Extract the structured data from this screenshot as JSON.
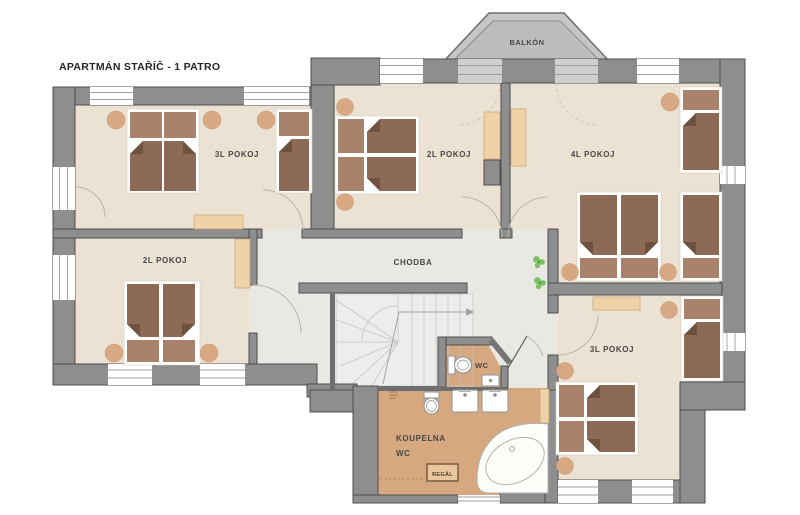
{
  "title": "APARTMÁN STAŘÍČ - 1 PATRO",
  "balcony": {
    "label": "BALKÓN"
  },
  "rooms": {
    "top_left": {
      "label": "3L POKOJ"
    },
    "top_center": {
      "label": "2L POKOJ"
    },
    "top_right": {
      "label": "4L POKOJ"
    },
    "mid_left": {
      "label": "2L POKOJ"
    },
    "corridor": {
      "label": "CHODBA"
    },
    "wc": {
      "label": "WC"
    },
    "bathroom": {
      "label_line1": "KOUPELNA",
      "label_line2": "WC",
      "shelf_label": "REGÁL"
    },
    "bottom_right": {
      "label": "3L POKOJ"
    }
  },
  "colors": {
    "wall": "#8e8e8e",
    "wall_outline": "#4e4e4e",
    "room_floor": "#ebe2d4",
    "corridor_floor": "#e9e8e3",
    "bathroom_floor": "#d5a87f",
    "bed_duvet": "#8d6a55",
    "bed_pillow": "#a9826b",
    "nightstand": "#d8a882",
    "furniture": "#f0d2a9",
    "balcony": "#bdbdbd",
    "plant": "#7cc065"
  }
}
